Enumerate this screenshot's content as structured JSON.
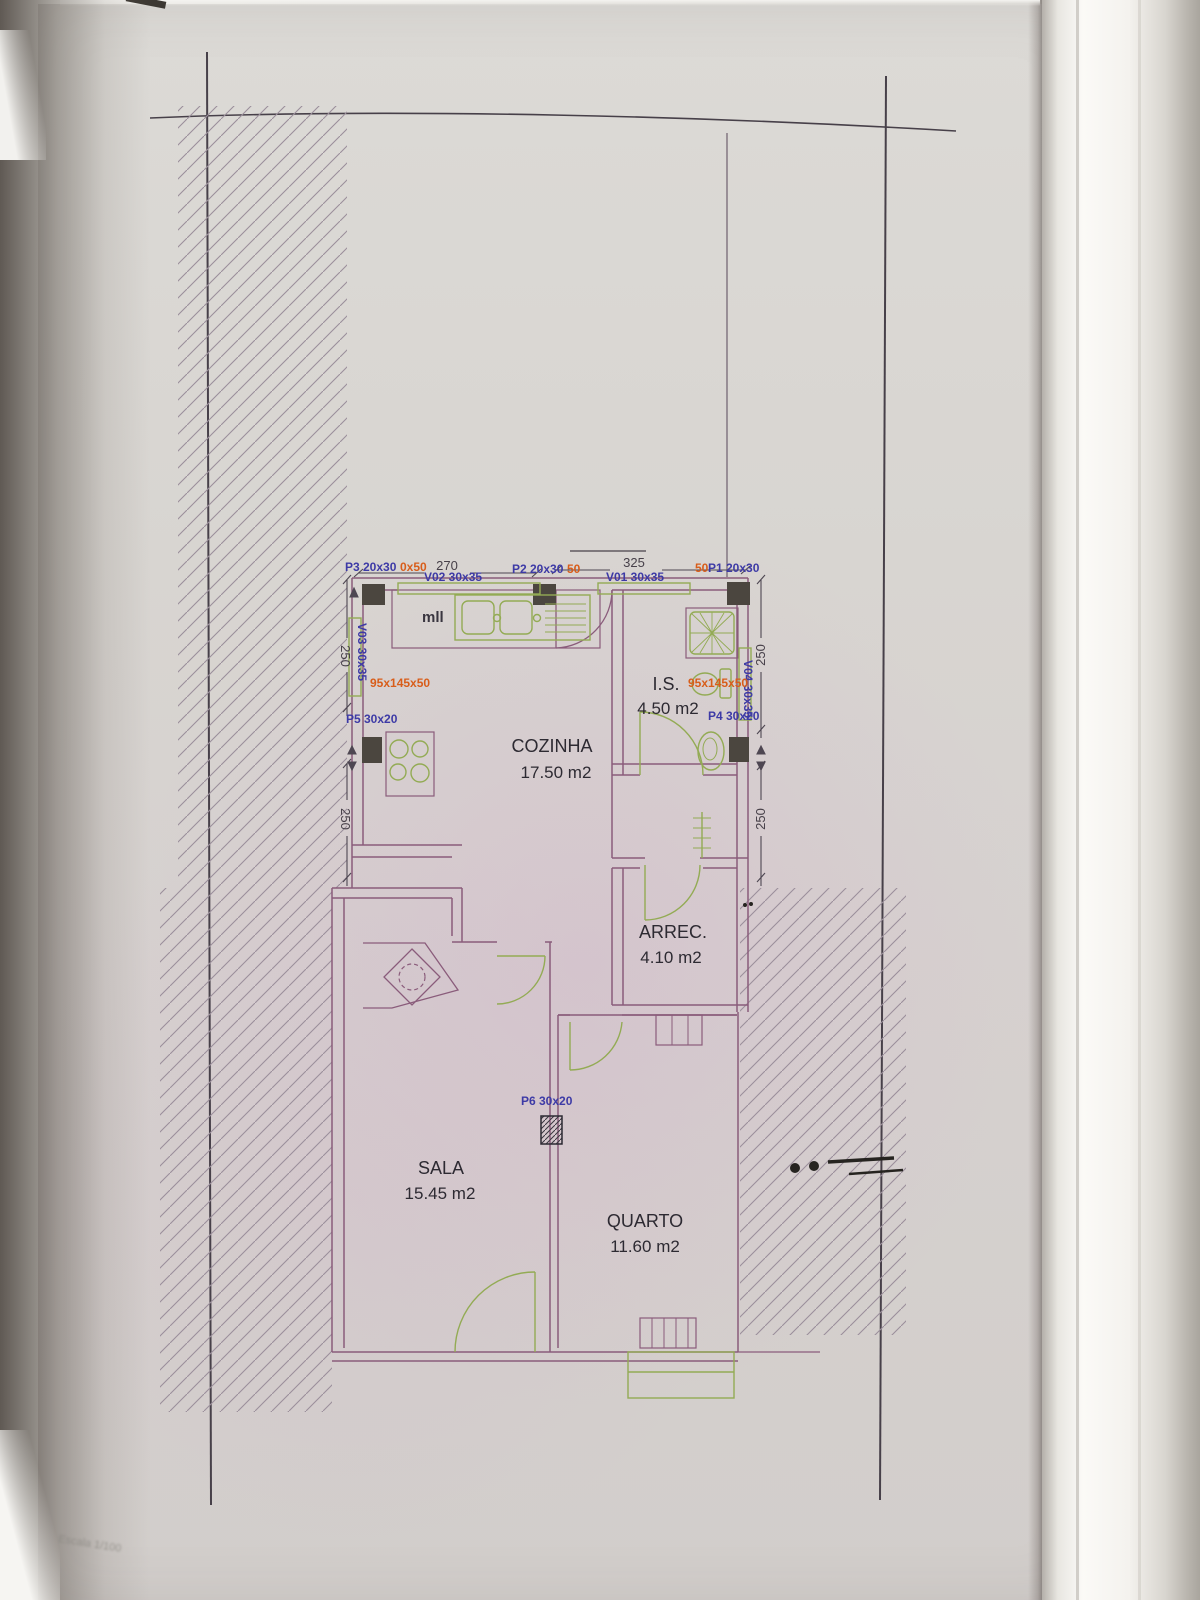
{
  "photo": {
    "escala_note": "Escala 1/100"
  },
  "plan": {
    "rooms": {
      "cozinha": {
        "name": "COZINHA",
        "area": "17.50 m2"
      },
      "is": {
        "name": "I.S.",
        "area": "4.50 m2"
      },
      "arrec": {
        "name": "ARREC.",
        "area": "4.10 m2"
      },
      "sala": {
        "name": "SALA",
        "area": "15.45 m2"
      },
      "quarto": {
        "name": "QUARTO",
        "area": "11.60 m2"
      }
    },
    "dimensions": {
      "top_left": "270",
      "top_right": "325",
      "left_upper": "250",
      "left_lower": "250",
      "right_upper": "250",
      "right_lower": "250"
    },
    "openings": {
      "p1": "P1 20x30",
      "p2": "P2 20x30",
      "p3": "P3 20x30",
      "p4": "P4 30x20",
      "p5": "P5 30x20",
      "p6": "P6 30x20",
      "v01": "V01 30x35",
      "v02": "V02 30x35",
      "v03": "V03 30x35",
      "v04": "V04 30x35"
    },
    "sill_notes": {
      "left": "95x145x50",
      "right": "95x145x50",
      "p3_suffix": "0x50",
      "p2_suffix": "50",
      "p1_prefix": "50"
    },
    "annotations": {
      "counter": "mll"
    }
  }
}
